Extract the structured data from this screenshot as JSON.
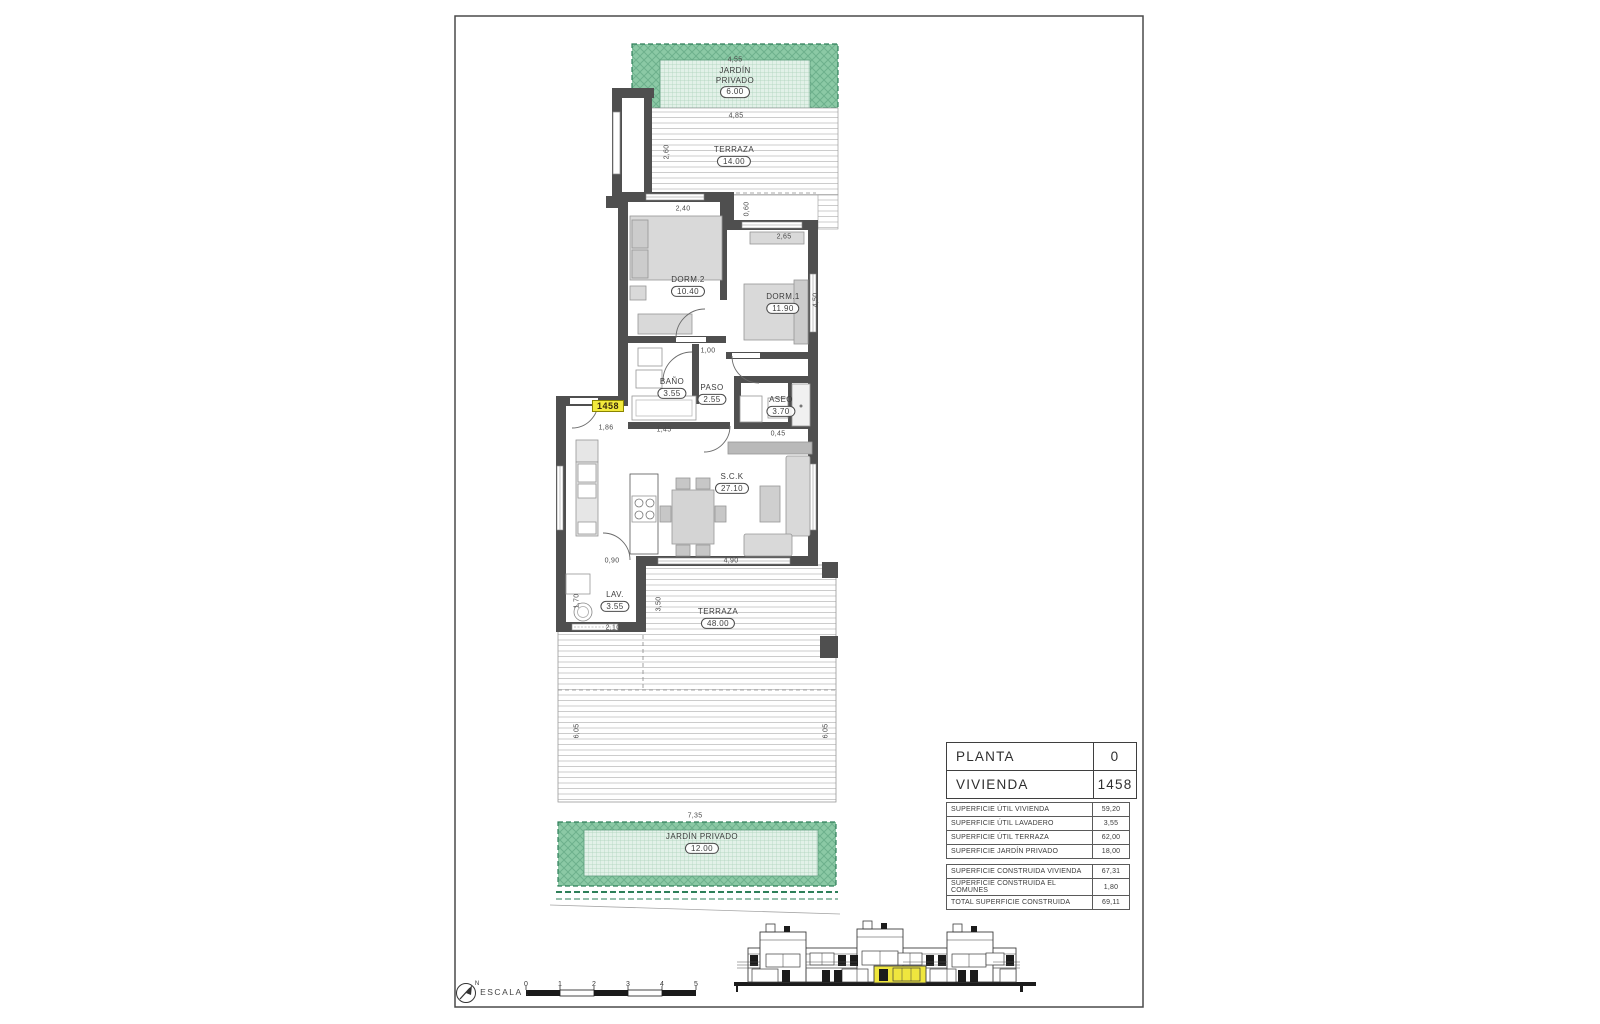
{
  "title_block": {
    "planta_label": "PLANTA",
    "planta_value": "0",
    "vivienda_label": "VIVIENDA",
    "vivienda_value": "1458"
  },
  "surface_table": {
    "rows": [
      {
        "label": "SUPERFICIE ÚTIL VIVIENDA",
        "value": "59,20"
      },
      {
        "label": "SUPERFICIE ÚTIL LAVADERO",
        "value": "3,55"
      },
      {
        "label": "SUPERFICIE ÚTIL TERRAZA",
        "value": "62,00"
      },
      {
        "label": "SUPERFICIE JARDÍN PRIVADO",
        "value": "18,00"
      }
    ],
    "totals": [
      {
        "label": "SUPERFICIE CONSTRUIDA VIVIENDA",
        "value": "67,31"
      },
      {
        "label": "SUPERFICIE CONSTRUIDA EL COMUNES",
        "value": "1,80"
      },
      {
        "label": "TOTAL SUPERFICIE CONSTRUIDA",
        "value": "69,11"
      }
    ]
  },
  "plan": {
    "unit_tag": "1458",
    "rooms": {
      "garden_top": {
        "name": "JARDÍN PRIVADO",
        "area": "6.00"
      },
      "terrace_top": {
        "name": "TERRAZA",
        "area": "14.00"
      },
      "dorm2": {
        "name": "DORM.2",
        "area": "10.40"
      },
      "dorm1": {
        "name": "DORM.1",
        "area": "11.90"
      },
      "bano": {
        "name": "BAÑO",
        "area": "3.55"
      },
      "paso": {
        "name": "PASO",
        "area": "2.55"
      },
      "aseo": {
        "name": "ASEO",
        "area": "3.70"
      },
      "sck": {
        "name": "S.C.K",
        "area": "27.10"
      },
      "lav": {
        "name": "LAV.",
        "area": "3.55"
      },
      "terrace_bottom": {
        "name": "TERRAZA",
        "area": "48.00"
      },
      "garden_bottom": {
        "name": "JARDÍN PRIVADO",
        "area": "12.00"
      }
    },
    "dims": {
      "top_garden": "4,55",
      "top_terrace": "4,85",
      "entry_side": "2,60",
      "dorm2_top": "2,40",
      "step": "0,60",
      "dorm1_top": "2,65",
      "dorm1_side": "4,50",
      "hall": "1,00",
      "entry_w": "1,86",
      "bano_w": "1,45",
      "aseo_b": "0,45",
      "sck_b1": "0,90",
      "sck_b2": "4,90",
      "lav_side": "1,70",
      "lav_mid": "3,50",
      "lav_b": "2,10",
      "terr_left": "6,05",
      "terr_right": "6,05",
      "garden_b": "7,35"
    }
  },
  "scale_bar": {
    "label": "ESCALA :",
    "north": "N",
    "ticks": [
      "0",
      "1",
      "2",
      "3",
      "4",
      "5"
    ]
  },
  "colors": {
    "garden_green": "#8bc9a5",
    "garden_light": "#e2f1e8",
    "wall_gray": "#4f4f4f",
    "highlight_yellow": "#efe63e"
  }
}
